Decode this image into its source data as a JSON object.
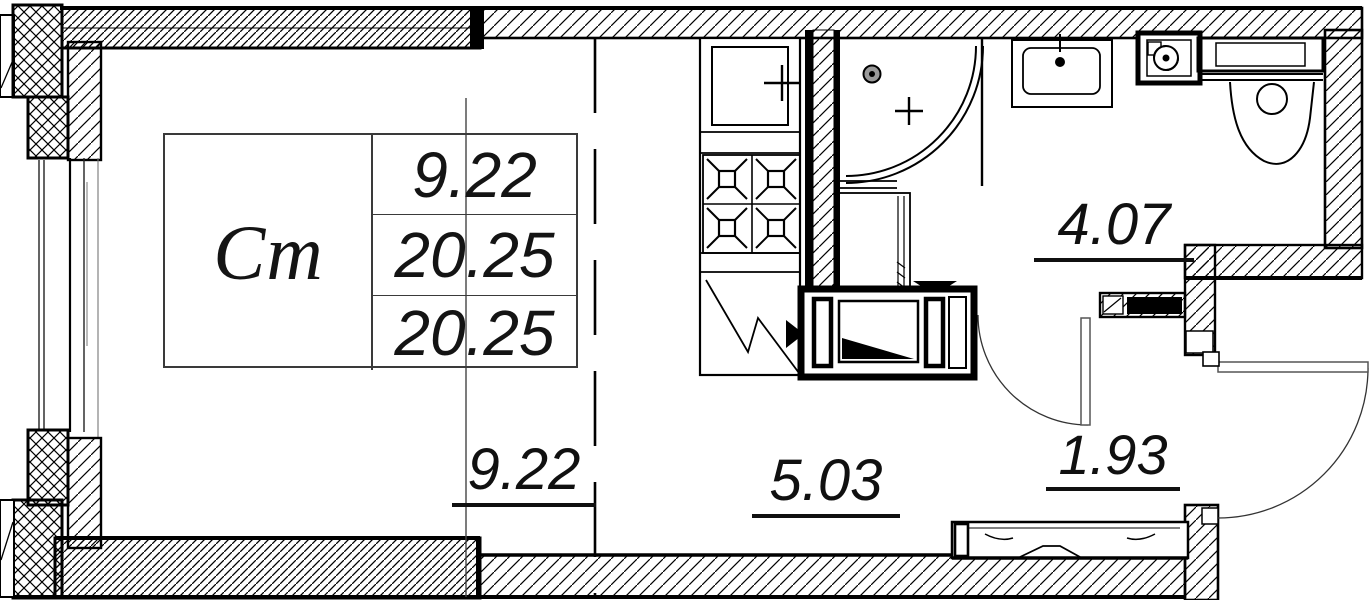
{
  "colors": {
    "line": "#000000",
    "thin_line": "#555555",
    "background": "#ffffff"
  },
  "unit_table": {
    "type_label": "Ст",
    "values": [
      "9.22",
      "20.25",
      "20.25"
    ]
  },
  "area_labels": {
    "living": "9.22",
    "kitchen": "5.03",
    "bathroom": "4.07",
    "hallway": "1.93"
  },
  "fixture_icons": [
    "kitchen-sink-icon",
    "stove-burners-icon",
    "corner-shower-icon",
    "shower-head-icon",
    "drain-cross-icon",
    "bath-sink-icon",
    "vent-fan-icon",
    "toilet-icon",
    "appliance-block-icon",
    "entry-threshold-icon",
    "door-swing-arc-icon",
    "window-icon"
  ]
}
